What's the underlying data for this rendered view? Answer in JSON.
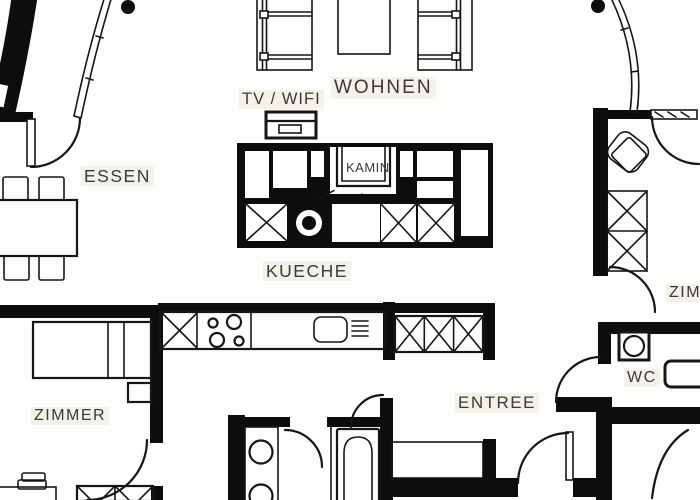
{
  "plan": {
    "type": "apartment-floorplan",
    "labels": {
      "essen": "ESSEN",
      "wohnen": "WOHNEN",
      "tv_wifi": "TV / WIFI",
      "kamin": "KAMIN",
      "kueche": "KUECHE",
      "zimmer_left": "ZIMMER",
      "zimmer_right": "ZIMMER",
      "wc": "WC",
      "entree": "ENTREE"
    },
    "colors": {
      "wall": "#0d0d0d",
      "floor": "#fdfdfc",
      "line": "#161616",
      "label_text": "#3a3a3a"
    }
  }
}
